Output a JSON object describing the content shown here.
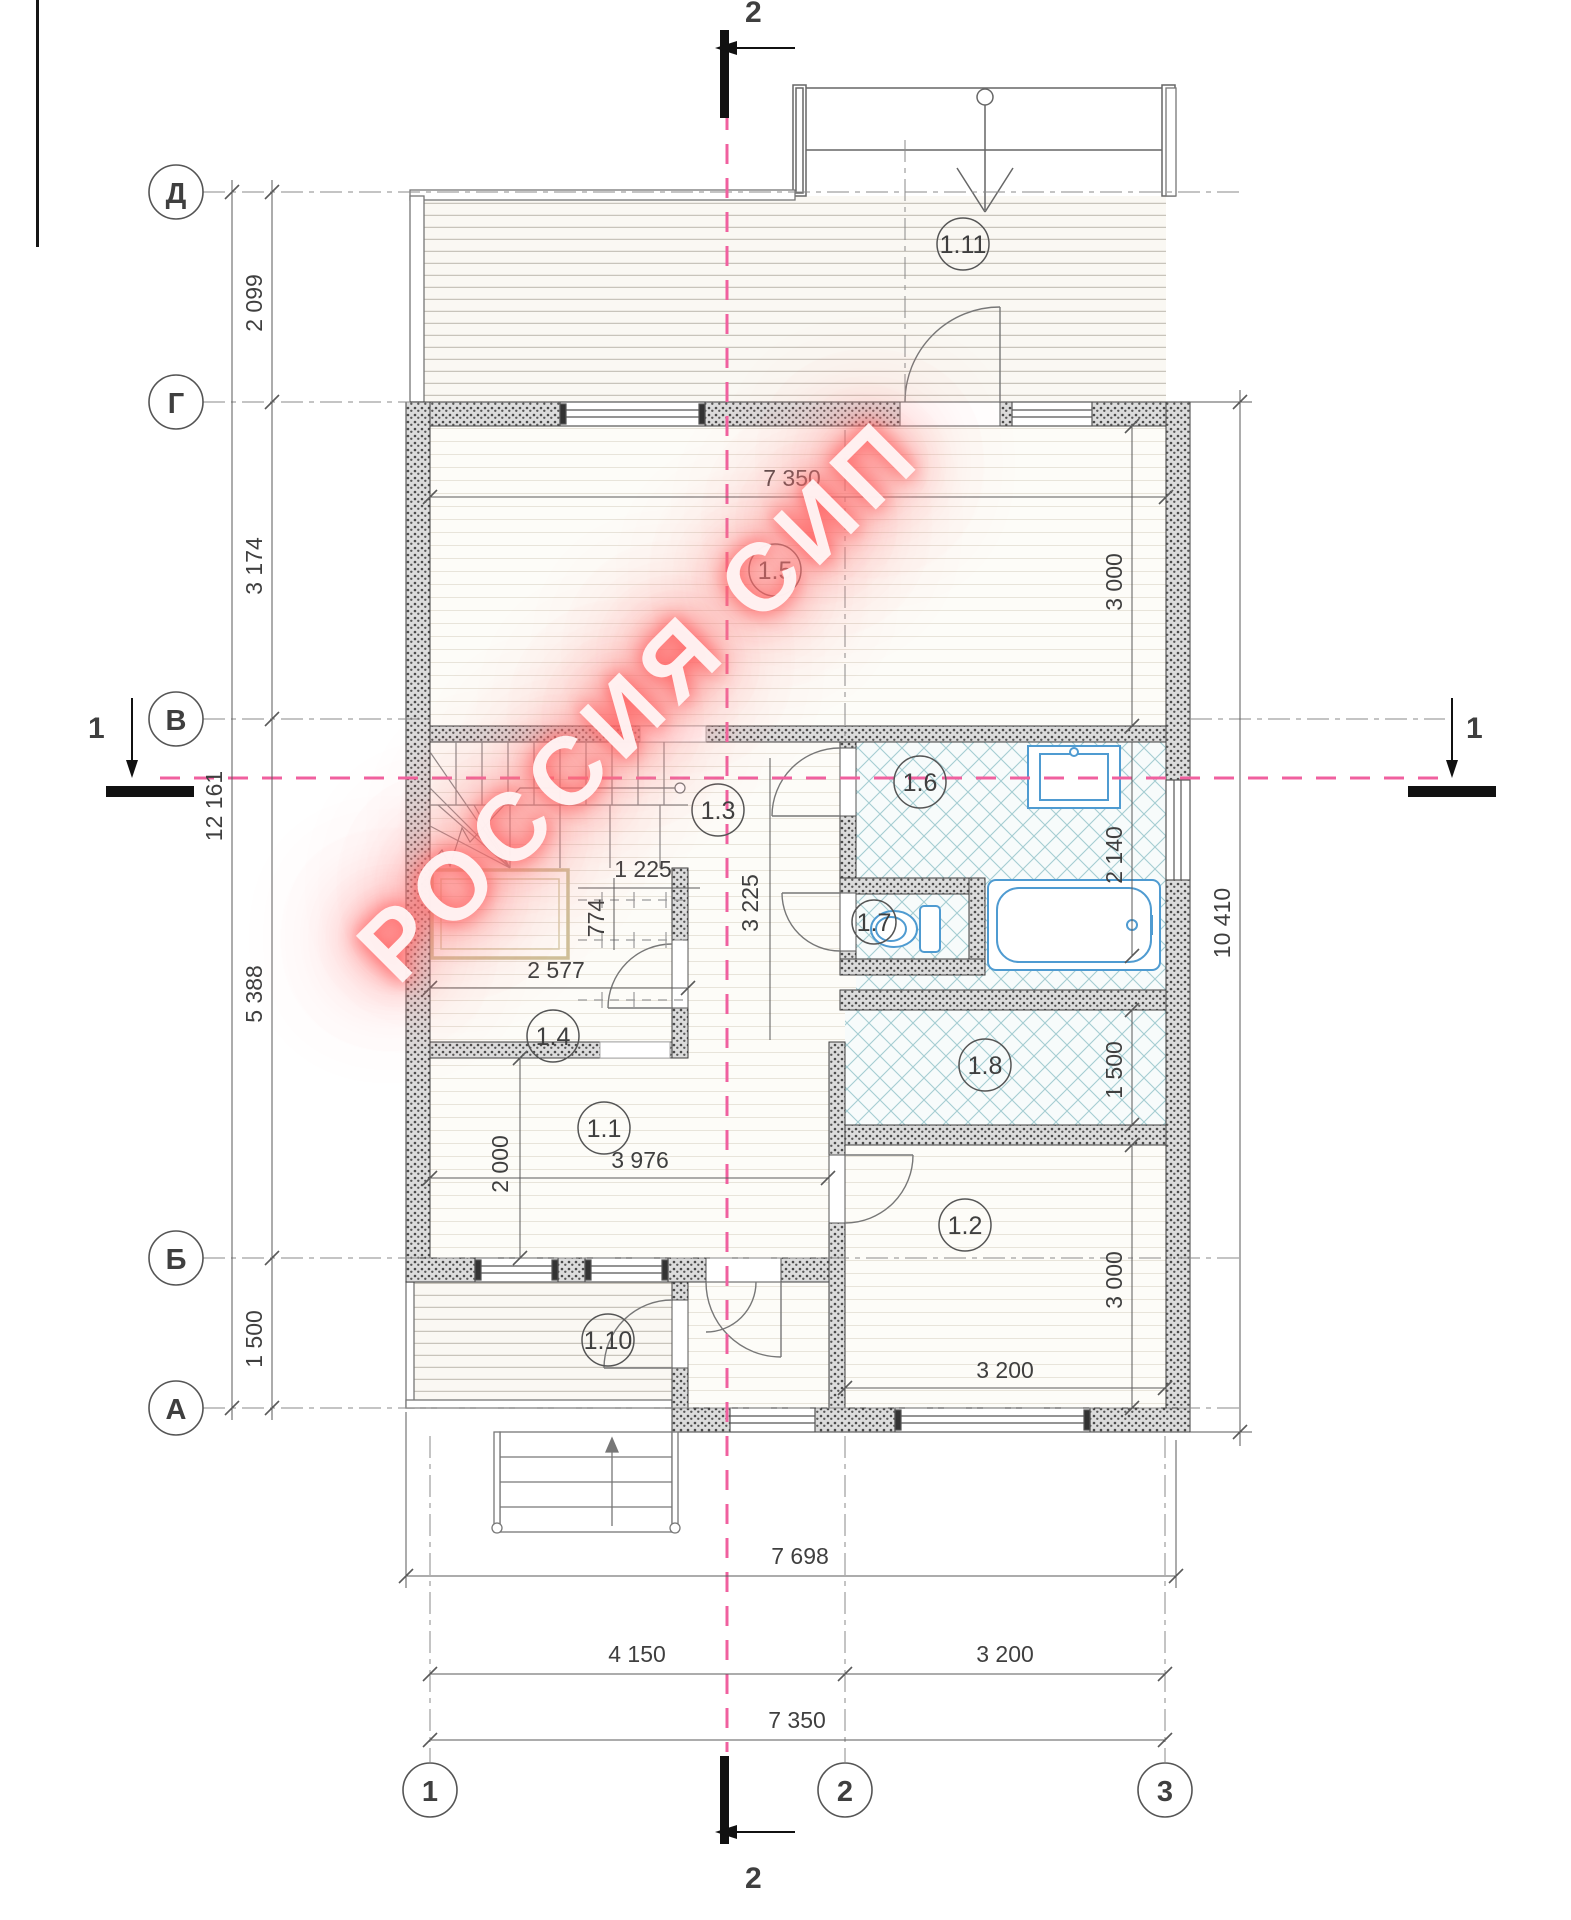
{
  "watermark": "РОССИЯ СИП",
  "axes": {
    "d": "Д",
    "g": "Г",
    "v": "В",
    "b": "Б",
    "a": "А",
    "c1": "1",
    "c2": "2",
    "c3": "3"
  },
  "section_marks": {
    "top": "2",
    "bottom": "2",
    "left": "1",
    "right": "1"
  },
  "rooms": {
    "r1_1": "1.1",
    "r1_2": "1.2",
    "r1_3": "1.3",
    "r1_4": "1.4",
    "r1_5": "1.5",
    "r1_6": "1.6",
    "r1_7": "1.7",
    "r1_8": "1.8",
    "r1_10": "1.10",
    "r1_11": "1.11"
  },
  "dims": {
    "left_total": "12 161",
    "left_dg": "2 099",
    "left_gv": "3 174",
    "left_vb": "5 388",
    "left_ba": "1 500",
    "right_total": "10 410",
    "right_r15": "3 000",
    "right_r16": "2 140",
    "right_r18": "1 500",
    "right_r12": "3 000",
    "top_interior": "7 350",
    "r11_w": "3 976",
    "r11_h": "2 000",
    "closet_w": "2 577",
    "hall_small": "774",
    "hall_w": "1 225",
    "hall_h": "3 225",
    "r12_w": "3 200",
    "bottom_ext": "7 698",
    "bottom_12": "4 150",
    "bottom_23": "3 200",
    "bottom_total": "7 350"
  },
  "colors": {
    "section_pink": "#f0609f",
    "fixture_blue": "#4f9bd1",
    "tile_teal": "#a5cdd2",
    "closet_tan": "#d3c79c",
    "watermark_red": "#ff6060",
    "wall_grey": "#4a4a4a"
  }
}
